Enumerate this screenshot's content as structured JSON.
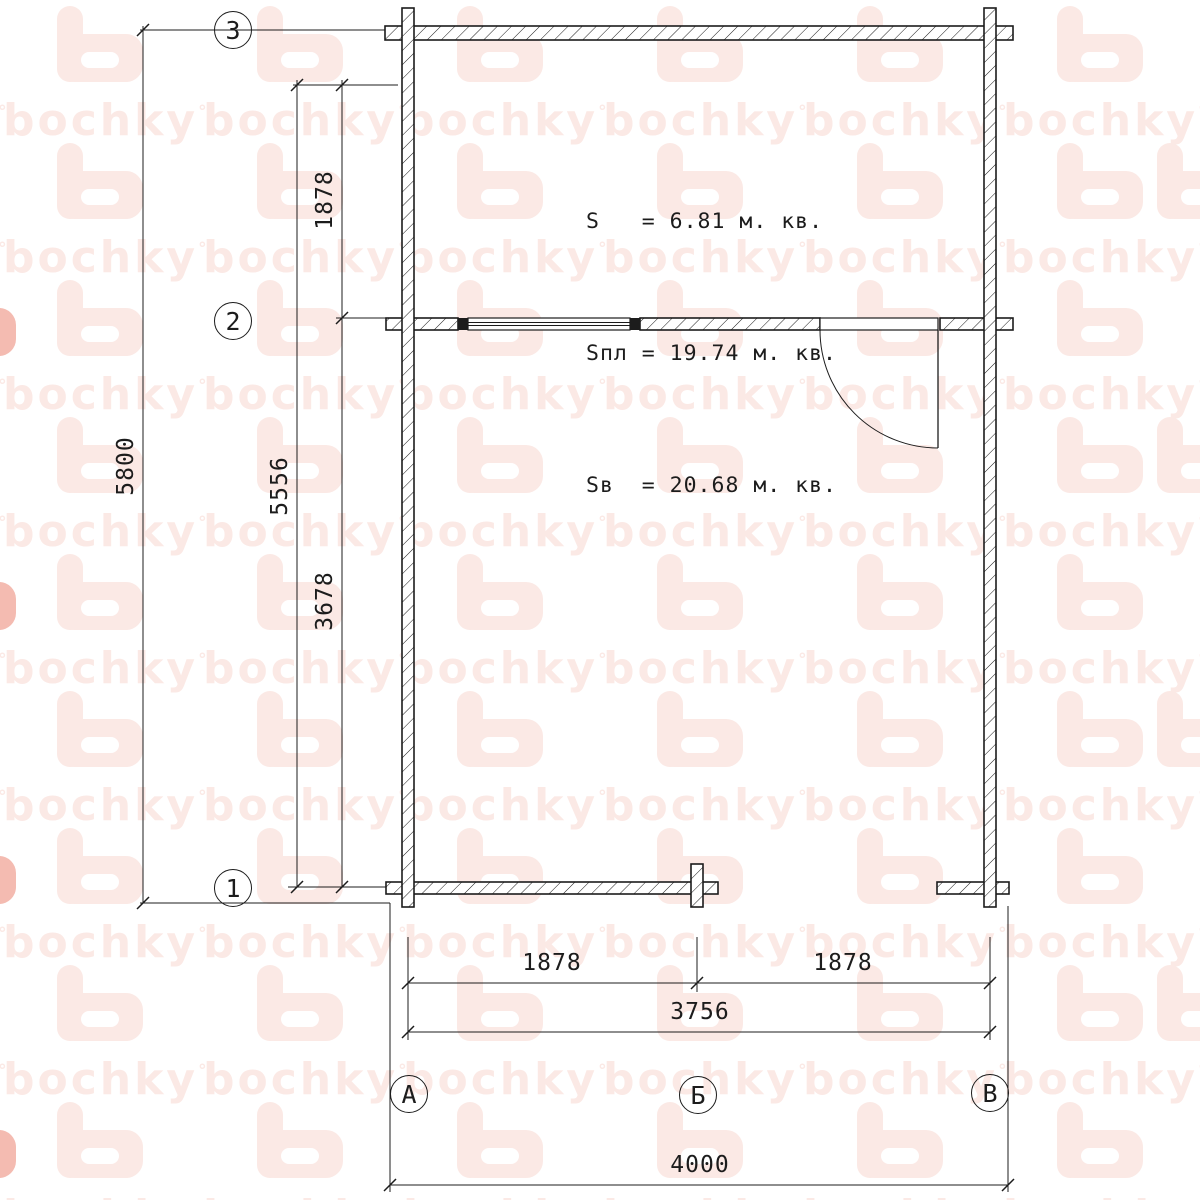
{
  "watermark": {
    "wordmark": "bochky",
    "mark": "°",
    "color": "#fbe9e5",
    "strong_color": "#f4bbb1"
  },
  "colors": {
    "line": "#1c1c1c",
    "paper": "#ffffff"
  },
  "area_summary": {
    "s_line": "S   = 6.81 м. кв.",
    "spl_line": "Sпл = 19.74 м. кв.",
    "sv_line": "Sв  = 20.68 м. кв."
  },
  "dims": {
    "overall_height": "5800",
    "axes_height": "5556",
    "axis_3_to_2": "1878",
    "axis_2_to_1": "3678",
    "axis_a_to_b": "1878",
    "axis_b_to_v": "1878",
    "axes_width": "3756",
    "overall_width": "4000"
  },
  "grid": {
    "rows": [
      {
        "label": "3"
      },
      {
        "label": "2"
      },
      {
        "label": "1"
      }
    ],
    "columns": [
      {
        "label": "А"
      },
      {
        "label": "Б"
      },
      {
        "label": "В"
      }
    ]
  }
}
